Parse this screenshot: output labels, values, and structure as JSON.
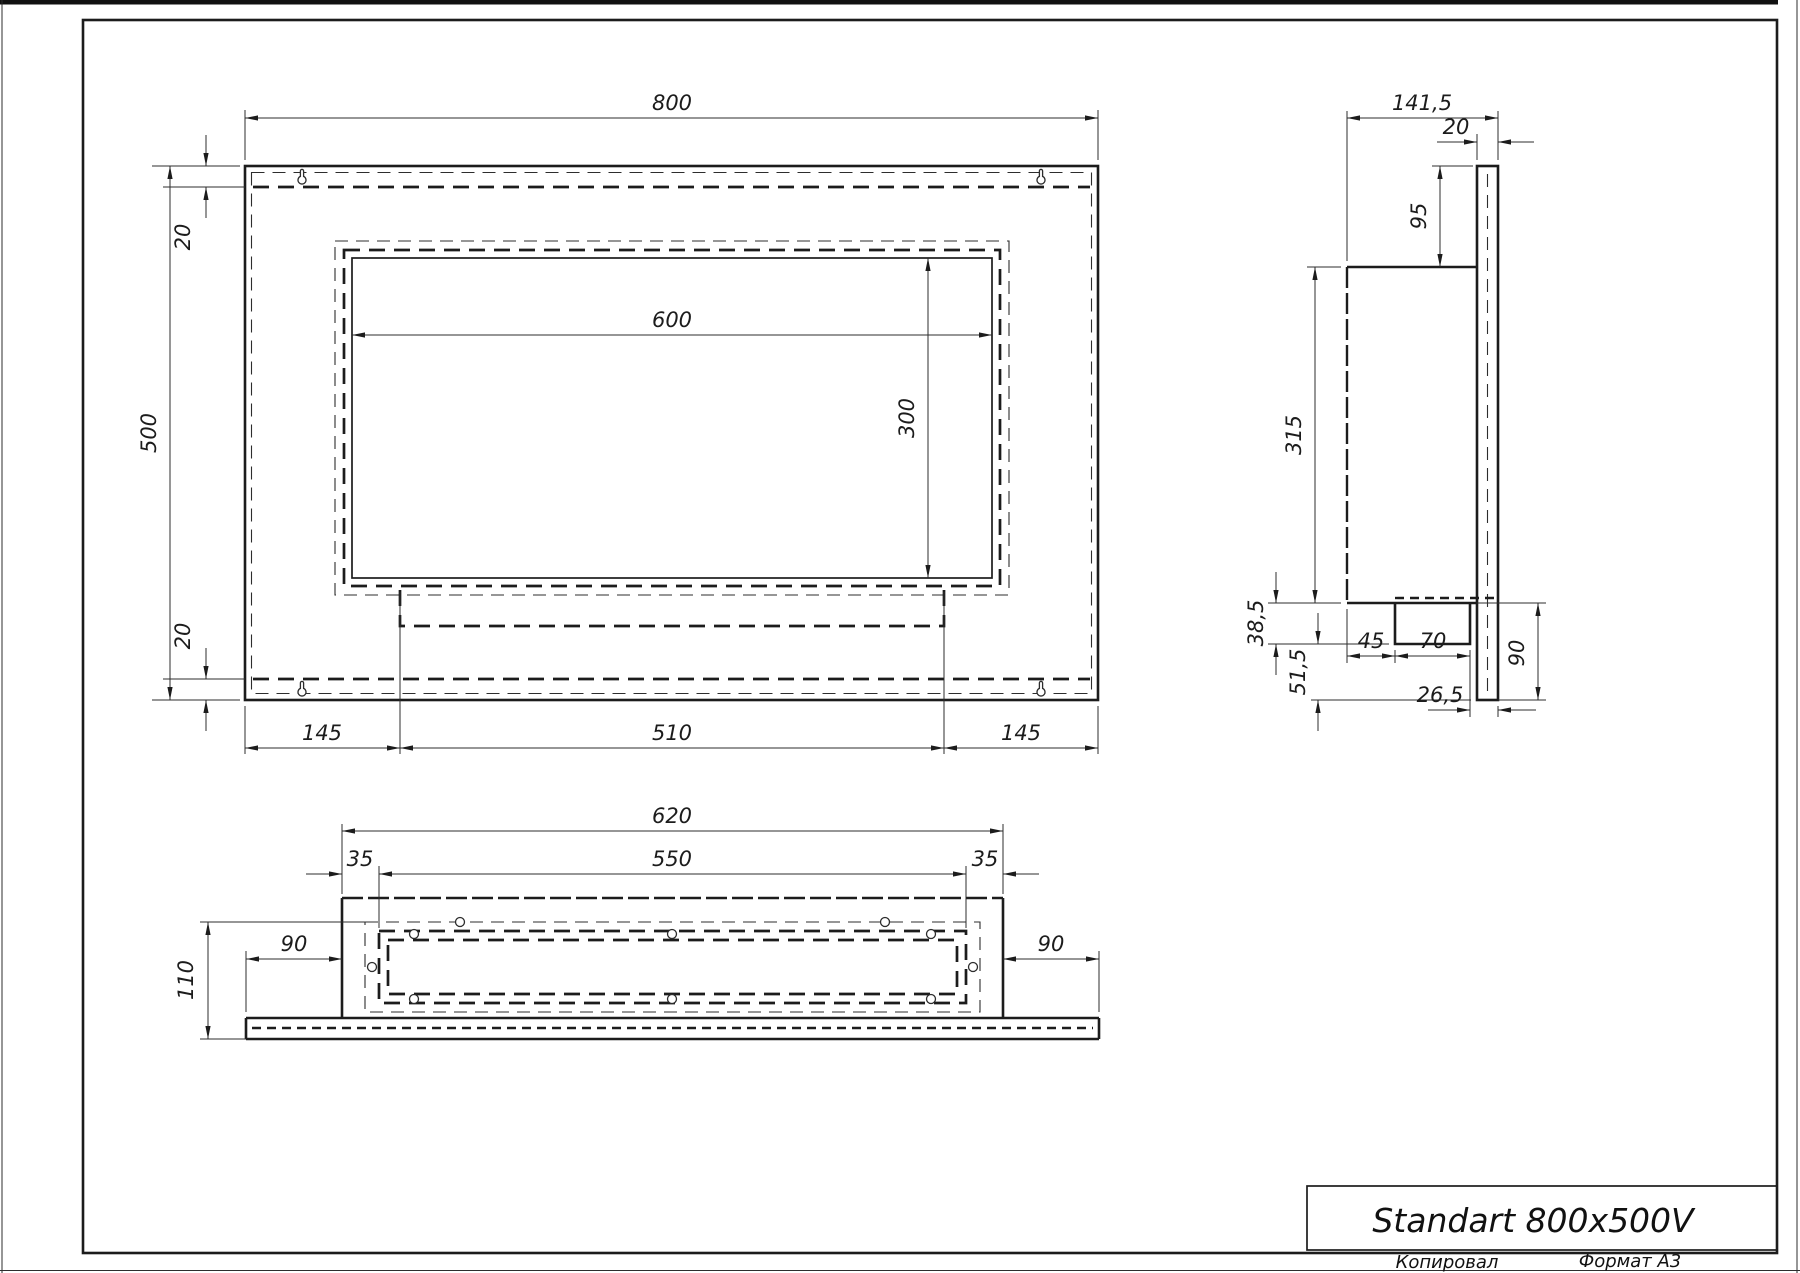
{
  "title_block": {
    "title": "Standart 800x500V",
    "copied_label": "Копировал",
    "format_label": "Формат А3"
  },
  "front_view": {
    "dims": {
      "total_width": "800",
      "total_height": "500",
      "top_inset": "20",
      "bottom_inset": "20",
      "opening_width": "600",
      "opening_height": "300",
      "left_margin": "145",
      "tray_width": "510",
      "right_margin": "145"
    }
  },
  "side_view": {
    "dims": {
      "total_depth": "141,5",
      "plate_thickness": "20",
      "top_to_body": "95",
      "body_height": "315",
      "tray_drop": "38,5",
      "tray_to_bottom": "51,5",
      "front_to_tray": "45",
      "tray_depth": "70",
      "tray_back_offset": "26,5",
      "lower_height": "90"
    }
  },
  "bottom_view": {
    "dims": {
      "body_width": "620",
      "opening_width": "550",
      "left_margin": "35",
      "right_margin": "35",
      "total_depth": "110",
      "left_wing": "90",
      "right_wing": "90"
    }
  }
}
